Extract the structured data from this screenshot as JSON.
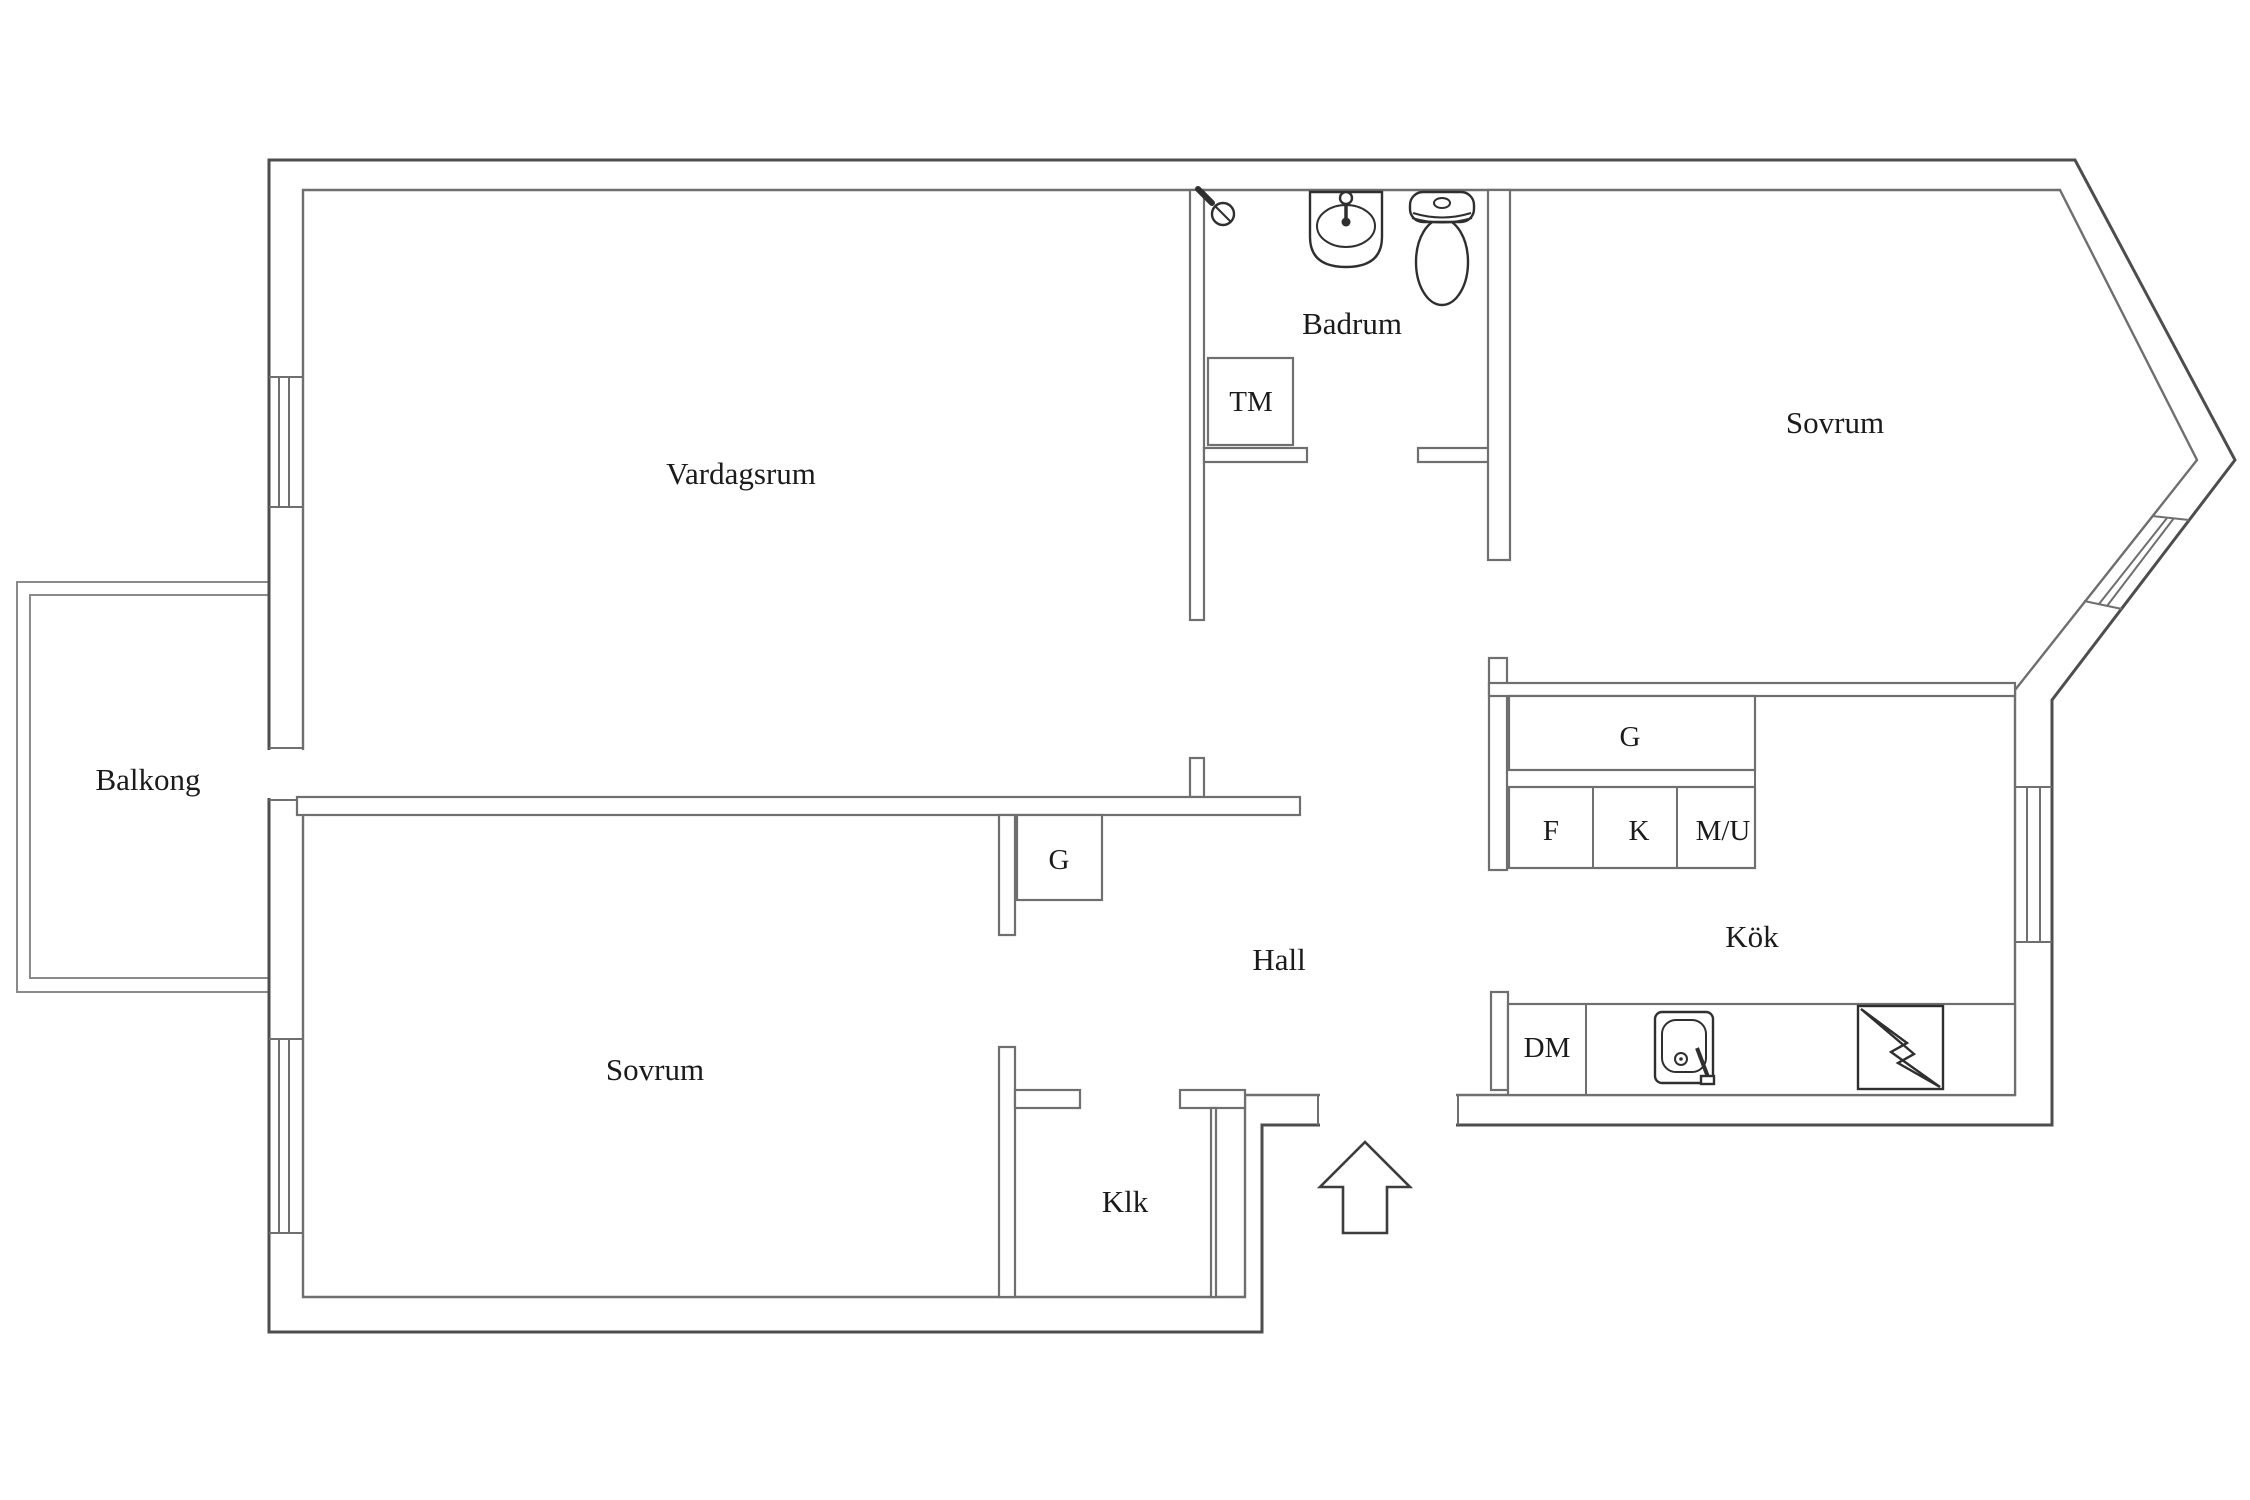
{
  "rooms": {
    "living_room": {
      "label": "Vardagsrum"
    },
    "bathroom": {
      "label": "Badrum"
    },
    "bedroom_right": {
      "label": "Sovrum"
    },
    "bedroom_left": {
      "label": "Sovrum"
    },
    "balcony": {
      "label": "Balkong"
    },
    "hall": {
      "label": "Hall"
    },
    "kitchen": {
      "label": "Kök"
    },
    "closet": {
      "label": "Klk"
    }
  },
  "fixtures": {
    "washing_machine": {
      "label": "TM"
    },
    "kitchen_cabinet": {
      "label": "G"
    },
    "unit_f": {
      "label": "F"
    },
    "unit_k": {
      "label": "K"
    },
    "unit_mu": {
      "label": "M/U"
    },
    "dishwasher": {
      "label": "DM"
    },
    "hall_wardrobe": {
      "label": "G"
    }
  },
  "icons": {
    "shower": "shower-head-icon",
    "washbasin": "washbasin-icon",
    "toilet": "toilet-icon",
    "kitchen_sink": "kitchen-sink-icon",
    "stove": "stove-lightning-icon",
    "entry": "entry-arrow-icon"
  },
  "colors": {
    "background": "#ffffff",
    "outer_wall": "#4d4d4d",
    "inner_wall": "#6f6f6f",
    "fixture_line": "#2f2f2f",
    "text": "#1b1b1b"
  }
}
